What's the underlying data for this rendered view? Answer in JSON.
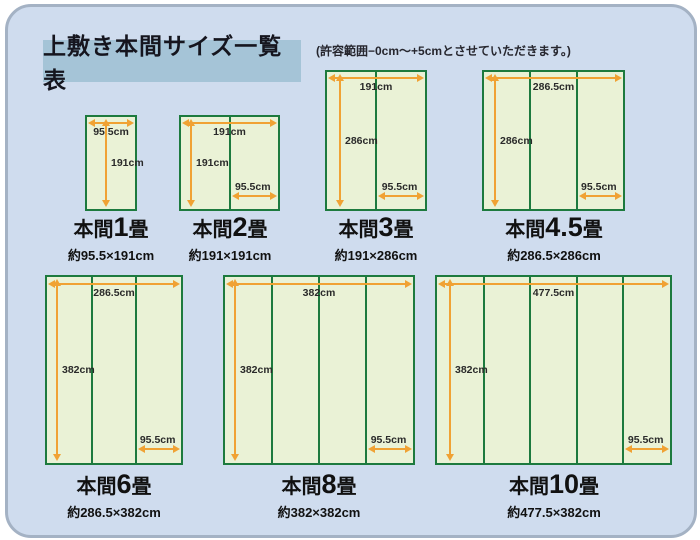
{
  "header": {
    "title": "上敷き本間サイズ一覧表"
  },
  "note": "(許容範囲−0cm〜+5cmとさせていただきます。)",
  "colors": {
    "panel_bg": "#cfdcee",
    "panel_border": "#a4b2c4",
    "header_bg": "#a5c4d7",
    "mat_fill": "#eaf2d6",
    "mat_border": "#1d7a3e",
    "arrow": "#f0a234"
  },
  "diagrams": [
    {
      "prefix": "本間",
      "number": "1",
      "unit": "畳",
      "approx": "約95.5×191cm",
      "width_label": "95.5cm",
      "height_label": "191cm",
      "strip_label": "",
      "strips": 1
    },
    {
      "prefix": "本間",
      "number": "2",
      "unit": "畳",
      "approx": "約191×191cm",
      "width_label": "191cm",
      "height_label": "191cm",
      "strip_label": "95.5cm",
      "strips": 2
    },
    {
      "prefix": "本間",
      "number": "3",
      "unit": "畳",
      "approx": "約191×286cm",
      "width_label": "191cm",
      "height_label": "286cm",
      "strip_label": "95.5cm",
      "strips": 2
    },
    {
      "prefix": "本間",
      "number": "4.5",
      "unit": "畳",
      "approx": "約286.5×286cm",
      "width_label": "286.5cm",
      "height_label": "286cm",
      "strip_label": "95.5cm",
      "strips": 3
    },
    {
      "prefix": "本間",
      "number": "6",
      "unit": "畳",
      "approx": "約286.5×382cm",
      "width_label": "286.5cm",
      "height_label": "382cm",
      "strip_label": "95.5cm",
      "strips": 3
    },
    {
      "prefix": "本間",
      "number": "8",
      "unit": "畳",
      "approx": "約382×382cm",
      "width_label": "382cm",
      "height_label": "382cm",
      "strip_label": "95.5cm",
      "strips": 4
    },
    {
      "prefix": "本間",
      "number": "10",
      "unit": "畳",
      "approx": "約477.5×382cm",
      "width_label": "477.5cm",
      "height_label": "382cm",
      "strip_label": "95.5cm",
      "strips": 5
    }
  ]
}
